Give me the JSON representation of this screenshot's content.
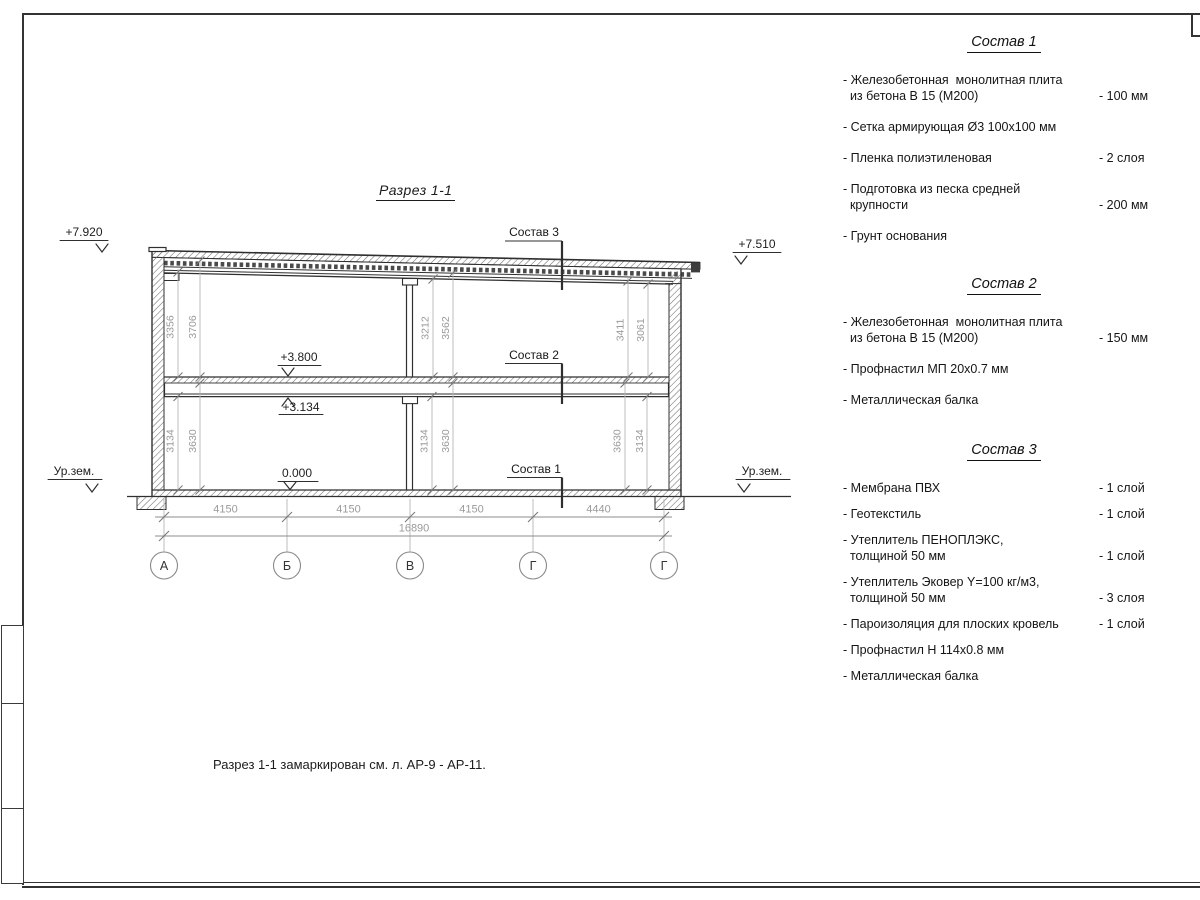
{
  "page": {
    "title": "Разрез 1-1",
    "note": "Разрез 1-1 замаркирован см. л. АР-9 - АР-11."
  },
  "drawing": {
    "elevations": {
      "roof_left": "+7.920",
      "roof_right": "+7.510",
      "slab": "+3.800",
      "beam": "+3.134",
      "floor": "0.000",
      "ground_left": "Ур.зем.",
      "ground_right": "Ур.зем."
    },
    "layer_labels": {
      "c1": "Состав 1",
      "c2": "Состав 2",
      "c3": "Состав 3"
    },
    "dims_upper": {
      "left": [
        "3356",
        "3706"
      ],
      "mid": [
        "3212",
        "3562"
      ],
      "right": [
        "3411",
        "3061"
      ]
    },
    "dims_lower": {
      "left": [
        "3134",
        "3630"
      ],
      "mid": [
        "3134",
        "3630"
      ],
      "right": [
        "3630",
        "3134"
      ]
    },
    "dims_bottom": {
      "bays": [
        "4150",
        "4150",
        "4150",
        "4440"
      ],
      "total": "16890"
    },
    "axes": [
      "А",
      "Б",
      "В",
      "Г",
      "Г"
    ]
  },
  "panel": {
    "comp1": {
      "heading": "Состав 1",
      "items": [
        {
          "name": "- Железобетонная  монолитная плита\n  из бетона В 15 (М200)",
          "value": "- 100 мм"
        },
        {
          "name": "- Сетка армирующая Ø3 100x100 мм",
          "value": ""
        },
        {
          "name": "- Пленка полиэтиленовая",
          "value": "-  2 слоя"
        },
        {
          "name": "- Подготовка из песка средней\n  крупности",
          "value": "- 200 мм"
        },
        {
          "name": "- Грунт основания",
          "value": ""
        }
      ]
    },
    "comp2": {
      "heading": "Состав 2",
      "items": [
        {
          "name": "- Железобетонная  монолитная плита\n  из бетона В 15 (М200)",
          "value": "- 150 мм"
        },
        {
          "name": "- Профнастил МП 20x0.7 мм",
          "value": ""
        },
        {
          "name": "- Металлическая балка",
          "value": ""
        }
      ]
    },
    "comp3": {
      "heading": "Состав 3",
      "items": [
        {
          "name": "- Мембрана ПВХ",
          "value": "- 1 слой"
        },
        {
          "name": "- Геотекстиль",
          "value": "- 1 слой"
        },
        {
          "name": "- Утеплитель ПЕНОПЛЭКС,\n  толщиной 50 мм",
          "value": "- 1 слой"
        },
        {
          "name": "- Утеплитель Эковер Y=100 кг/м3,\n  толщиной 50 мм",
          "value": "- 3 слоя"
        },
        {
          "name": "- Пароизоляция для плоских кровель",
          "value": "- 1 слой"
        },
        {
          "name": "- Профнастил Н 114x0.8 мм",
          "value": ""
        },
        {
          "name": "- Металлическая балка",
          "value": ""
        }
      ]
    }
  }
}
